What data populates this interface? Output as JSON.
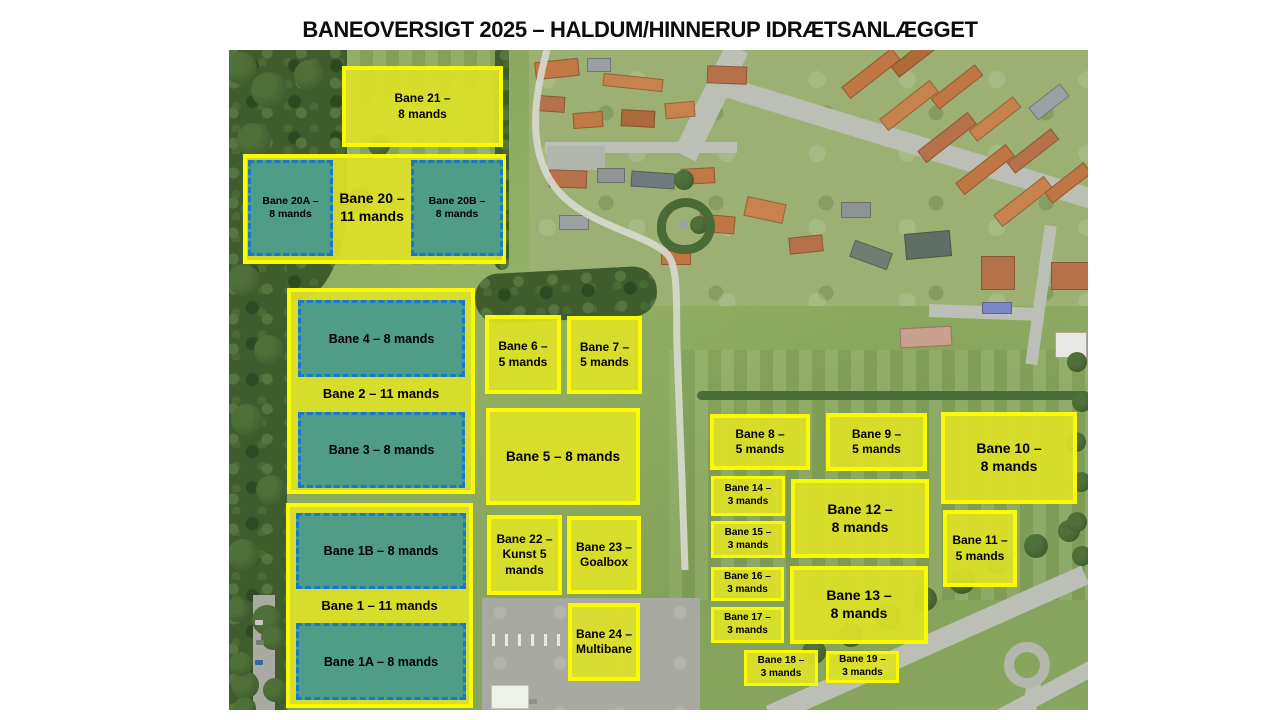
{
  "title": "BANEOVERSIGT 2025 – HALDUM/HINNERUP IDRÆTSANLÆGGET",
  "map": {
    "colors": {
      "field_fill": "#dee128",
      "field_border": "#fbfb00",
      "turf_fill": "#4f9c87",
      "turf_border": "#1579d3",
      "label_text": "#000000"
    },
    "fields": [
      {
        "name": "group-bane-20",
        "style": "yellow",
        "x": 14,
        "y": 104,
        "w": 263,
        "h": 110,
        "size": 12,
        "lines": []
      },
      {
        "name": "bane-20a",
        "style": "teal",
        "x": 19,
        "y": 110,
        "w": 85,
        "h": 96,
        "size": 10.5,
        "lines": [
          "Bane 20A –",
          "8 mands"
        ]
      },
      {
        "name": "bane-20-label",
        "style": "label",
        "x": 104,
        "y": 110,
        "w": 78,
        "h": 96,
        "size": 14,
        "lines": [
          "Bane 20 –",
          "11 mands"
        ]
      },
      {
        "name": "bane-20b",
        "style": "teal",
        "x": 182,
        "y": 110,
        "w": 92,
        "h": 96,
        "size": 10.5,
        "lines": [
          "Bane 20B –",
          "8 mands"
        ]
      },
      {
        "name": "bane-21",
        "style": "yellow",
        "x": 113,
        "y": 16,
        "w": 161,
        "h": 81,
        "size": 12,
        "lines": [
          "Bane 21 –",
          "8 mands"
        ]
      },
      {
        "name": "group-bane-2",
        "style": "yellow",
        "x": 58,
        "y": 238,
        "w": 188,
        "h": 206,
        "size": 12,
        "lines": []
      },
      {
        "name": "bane-4",
        "style": "teal",
        "x": 69,
        "y": 250,
        "w": 167,
        "h": 77,
        "size": 12.5,
        "lines": [
          "Bane 4 – 8 mands"
        ]
      },
      {
        "name": "bane-2-label",
        "style": "label",
        "x": 62,
        "y": 327,
        "w": 180,
        "h": 35,
        "size": 13,
        "lines": [
          "Bane 2 – 11 mands"
        ]
      },
      {
        "name": "bane-3",
        "style": "teal",
        "x": 69,
        "y": 362,
        "w": 167,
        "h": 76,
        "size": 12.5,
        "lines": [
          "Bane 3 – 8 mands"
        ]
      },
      {
        "name": "group-bane-1",
        "style": "yellow",
        "x": 57,
        "y": 453,
        "w": 187,
        "h": 205,
        "size": 12,
        "lines": []
      },
      {
        "name": "bane-1b",
        "style": "teal",
        "x": 67,
        "y": 463,
        "w": 170,
        "h": 76,
        "size": 12.5,
        "lines": [
          "Bane 1B – 8 mands"
        ]
      },
      {
        "name": "bane-1-label",
        "style": "label",
        "x": 61,
        "y": 539,
        "w": 179,
        "h": 34,
        "size": 13,
        "lines": [
          "Bane 1 – 11 mands"
        ]
      },
      {
        "name": "bane-1a",
        "style": "teal",
        "x": 67,
        "y": 573,
        "w": 170,
        "h": 77,
        "size": 12.5,
        "lines": [
          "Bane 1A – 8 mands"
        ]
      },
      {
        "name": "bane-6",
        "style": "yellow",
        "x": 256,
        "y": 265,
        "w": 76,
        "h": 79,
        "size": 12,
        "lines": [
          "Bane 6 –",
          "5 mands"
        ]
      },
      {
        "name": "bane-7",
        "style": "yellow",
        "x": 338,
        "y": 266,
        "w": 75,
        "h": 78,
        "size": 12,
        "lines": [
          "Bane 7 –",
          "5 mands"
        ]
      },
      {
        "name": "bane-5",
        "style": "yellow",
        "x": 257,
        "y": 358,
        "w": 154,
        "h": 97,
        "size": 13.5,
        "lines": [
          "Bane 5 – 8 mands"
        ]
      },
      {
        "name": "bane-22",
        "style": "yellow",
        "x": 258,
        "y": 465,
        "w": 75,
        "h": 80,
        "size": 12,
        "lines": [
          "Bane 22 –",
          "Kunst 5",
          "mands"
        ]
      },
      {
        "name": "bane-23",
        "style": "yellow",
        "x": 338,
        "y": 466,
        "w": 74,
        "h": 78,
        "size": 12,
        "lines": [
          "Bane 23 –",
          "Goalbox"
        ]
      },
      {
        "name": "bane-24",
        "style": "yellow",
        "x": 339,
        "y": 553,
        "w": 72,
        "h": 78,
        "size": 12,
        "lines": [
          "Bane 24 –",
          "Multibane"
        ]
      },
      {
        "name": "bane-8",
        "style": "yellow",
        "x": 481,
        "y": 364,
        "w": 100,
        "h": 56,
        "size": 12,
        "lines": [
          "Bane 8 –",
          "5 mands"
        ]
      },
      {
        "name": "bane-9",
        "style": "yellow",
        "x": 597,
        "y": 363,
        "w": 101,
        "h": 58,
        "size": 12,
        "lines": [
          "Bane 9 –",
          "5 mands"
        ]
      },
      {
        "name": "bane-10",
        "style": "yellow",
        "x": 712,
        "y": 362,
        "w": 136,
        "h": 92,
        "size": 14,
        "lines": [
          "Bane 10 –",
          "8 mands"
        ]
      },
      {
        "name": "bane-14",
        "style": "yellow",
        "x": 482,
        "y": 426,
        "w": 74,
        "h": 40,
        "size": 10,
        "lines": [
          "Bane 14 –",
          "3 mands"
        ]
      },
      {
        "name": "bane-15",
        "style": "yellow",
        "x": 482,
        "y": 471,
        "w": 74,
        "h": 37,
        "size": 10,
        "lines": [
          "Bane 15 –",
          "3 mands"
        ]
      },
      {
        "name": "bane-12",
        "style": "yellow",
        "x": 562,
        "y": 429,
        "w": 138,
        "h": 79,
        "size": 14,
        "lines": [
          "Bane 12 –",
          "8 mands"
        ]
      },
      {
        "name": "bane-11",
        "style": "yellow",
        "x": 714,
        "y": 460,
        "w": 74,
        "h": 77,
        "size": 12,
        "lines": [
          "Bane 11 –",
          "5 mands"
        ]
      },
      {
        "name": "bane-16",
        "style": "yellow",
        "x": 482,
        "y": 517,
        "w": 73,
        "h": 34,
        "size": 10,
        "lines": [
          "Bane 16 –",
          "3 mands"
        ]
      },
      {
        "name": "bane-17",
        "style": "yellow",
        "x": 482,
        "y": 557,
        "w": 73,
        "h": 36,
        "size": 10,
        "lines": [
          "Bane 17 –",
          "3 mands"
        ]
      },
      {
        "name": "bane-13",
        "style": "yellow",
        "x": 561,
        "y": 516,
        "w": 138,
        "h": 78,
        "size": 14,
        "lines": [
          "Bane 13 –",
          "8 mands"
        ]
      },
      {
        "name": "bane-18",
        "style": "yellow",
        "x": 515,
        "y": 600,
        "w": 74,
        "h": 36,
        "size": 10,
        "lines": [
          "Bane 18 –",
          "3 mands"
        ]
      },
      {
        "name": "bane-19",
        "style": "yellow",
        "x": 597,
        "y": 601,
        "w": 73,
        "h": 32,
        "size": 10,
        "lines": [
          "Bane 19 –",
          "3 mands"
        ]
      }
    ]
  }
}
